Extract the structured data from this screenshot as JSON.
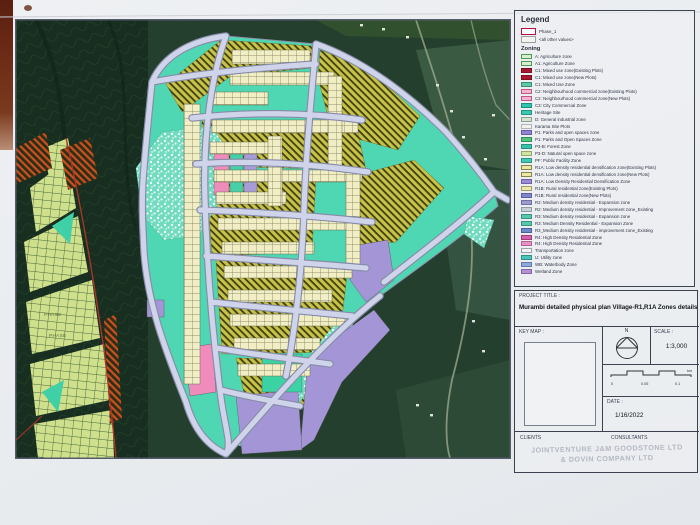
{
  "legend": {
    "title": "Legend",
    "top_items": [
      {
        "label": "Phase_1",
        "color": "#ffffff",
        "border": "#b5103c",
        "thick": true
      },
      {
        "label": "<all other values>",
        "color": "#f4f2ee",
        "border": "#9aa0a8"
      }
    ],
    "zoning_header": "Zoning",
    "zoning_items": [
      {
        "label": "A: Agriculture zone",
        "color": "#d9efcf",
        "border": "#4a9c55",
        "pattern": "hatch-green"
      },
      {
        "label": "A1: Agriculture Zone",
        "color": "#d9efcf",
        "border": "#4a9c55",
        "pattern": "hatch-green"
      },
      {
        "label": "C1: Mixed use zone(Existing Plots)",
        "color": "#a81830",
        "border": "#7a1022"
      },
      {
        "label": "C1: Mixed use zone(New Plots)",
        "color": "#a81830",
        "border": "#7a1022"
      },
      {
        "label": "C1: Mixed Use Zone",
        "color": "#5fc9a5",
        "border": "#3a8f74"
      },
      {
        "label": "C2: Neighbourhood commercial zone(Existing Plots)",
        "color": "#f4b4ce",
        "border": "#c2558a"
      },
      {
        "label": "C2: Neighbourhood commercial zone(New Plots)",
        "color": "#f4b4ce",
        "border": "#c2558a"
      },
      {
        "label": "C3: City Commercial Zone",
        "color": "#2fc4b2",
        "border": "#1f8d80"
      },
      {
        "label": "Heritage Site",
        "color": "#3cc8b0",
        "border": "#2a9280"
      },
      {
        "label": "D: General industrial zone",
        "color": "#d4e2d2",
        "border": "#8aa38c"
      },
      {
        "label": "Karama Site Plots",
        "color": "#f2f2ec",
        "border": "#b2b6ba"
      },
      {
        "label": "P1: Parks and open spaces zone",
        "color": "#9183cd",
        "border": "#675bab"
      },
      {
        "label": "P1: Parks and Open Spaces Zone",
        "color": "#4fc47a",
        "border": "#2f9153"
      },
      {
        "label": "P3-B: Forest Zone",
        "color": "#37c2a8",
        "border": "#26917d"
      },
      {
        "label": "P3-D: Natural open space zone",
        "color": "#cfe3a4",
        "border": "#93ad62"
      },
      {
        "label": "PF: Public Facility Zone",
        "color": "#43c9b2",
        "border": "#2e9683"
      },
      {
        "label": "R1A: Low density residential densification zone(Existing Plots)",
        "color": "#ece7a6",
        "border": "#8a8545",
        "pattern": "hatch-yellow"
      },
      {
        "label": "R1A: Low density residential densification zone(New Plots)",
        "color": "#ece7a6",
        "border": "#8a8545",
        "pattern": "hatch-yellow"
      },
      {
        "label": "R1A: Low Density Residential Densification Zone",
        "color": "#9c8dd2",
        "border": "#6f61a8"
      },
      {
        "label": "R1B: Rural residential zone(Existing Plots)",
        "color": "#ece9b0",
        "border": "#a39f64"
      },
      {
        "label": "R1B: Rural residential zone(New Plots)",
        "color": "#7f86cc",
        "border": "#5a60a0"
      },
      {
        "label": "R2: Medium density residential - Expansion zone",
        "color": "#9a9ccf",
        "border": "#6f71a5"
      },
      {
        "label": "R2: Medium density residential - Improvement zone_Existing",
        "color": "#c9cfd8",
        "border": "#939aa8"
      },
      {
        "label": "R3: Medium density residential - Expansion zone",
        "color": "#57c8ae",
        "border": "#3c9480"
      },
      {
        "label": "R3: Medium Density Residential - Expansion Zone",
        "color": "#57c8ae",
        "border": "#3c9480"
      },
      {
        "label": "R3_Medium density residential - improvement zone_Existing",
        "color": "#6d8bcb",
        "border": "#4a639e"
      },
      {
        "label": "R4: High Density Residential Zone",
        "color": "#d263a8",
        "border": "#a03d7e"
      },
      {
        "label": "R4: High Density Residential Zone",
        "color": "#ea92c4",
        "border": "#b85e92"
      },
      {
        "label": "Transportation zone",
        "color": "#f4f4f6",
        "border": "#9aa2aa"
      },
      {
        "label": "U: Utility zone",
        "color": "#49c5ba",
        "border": "#329087"
      },
      {
        "label": "WB: Waterbody Zone",
        "color": "#8fa9da",
        "border": "#6379ad"
      },
      {
        "label": "Wetland Zone",
        "color": "#b392d2",
        "border": "#8365a5"
      }
    ]
  },
  "title_block": {
    "project_title_label": "PROJECT TITLE :",
    "project_title": "Murambi detailed physical plan  Village-R1,R1A Zones details",
    "key_map_label": "KEY MAP :",
    "north_letter": "N",
    "scale_label": "SCALE :",
    "scale_value": "1:3,000",
    "scale_ticks": [
      "0",
      "0.05",
      "0.1"
    ],
    "scale_unit": "km",
    "date_label": "DATE :",
    "date_value": "1/16/2022",
    "clients_label": "CLIENTS",
    "consultants_label": "CONSULTANTS",
    "firm_line1": "JOINTVENTURE J&M GOODSTONE LTD",
    "firm_line2": "& DOVIN COMPANY LTD"
  },
  "map": {
    "phase_labels": [
      "PHASE",
      "PHASE"
    ],
    "colors": {
      "paper": "#edeff1",
      "aerial_dark": "#182e20",
      "aerial_mid": "#243f2e",
      "aerial_light": "#3b5a42",
      "village_teal": "#4fd7b3",
      "plot_cream": "#f1eec6",
      "hatch_yellow": "#c6c347",
      "road": "#d0d4ea",
      "pink": "#ef8cbc",
      "lavender": "#a496d6",
      "bright_green": "#3bd3a4",
      "speckle_teal": "#6fdcc0",
      "left_parcels": "#cfe08d",
      "orange_hatch": "#cf4f1c",
      "table_maroon": "#5a1f10"
    }
  }
}
